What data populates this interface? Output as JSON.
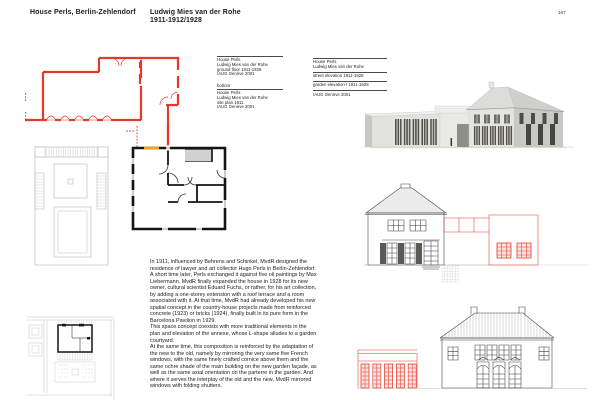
{
  "header": {
    "project": "House Perls, Berlin-Zehlendorf",
    "architect": "Ludwig Mies van der Rohe",
    "dates": "1911-1912/1928",
    "page_number": "167"
  },
  "captions": {
    "left_top": {
      "title": "House Perls",
      "architect": "Ludwig Mies van der Rohe",
      "subject": "ground floor 1911-1928",
      "credit": "IAUG Genève 2001"
    },
    "position_label": "bottom",
    "left_bottom": {
      "title": "House Perls",
      "architect": "Ludwig Mies van der Rohe",
      "subject": "site plan 1911",
      "credit": "IAUG Genève 2001"
    },
    "right": {
      "title": "House Perls",
      "architect": "Ludwig Mies van der Rohe",
      "subject_1": "street elevation 1911-1928",
      "subject_2": "garden elevation I 1911-1928",
      "credit": "IAUG Genève 2001"
    }
  },
  "body": {
    "para1": "In 1911, influenced by Behrens and Schinkel, MvdR designed the residence of lawyer and art collector Hugo Perls in Berlin-Zehlendorf. A short time later, Perls exchanged it against five oil paintings by Max Liebermann. MvdR finally expanded the house in 1928 for its new owner, cultural scientist Eduard Fuchs, or rather, for his art collection, by adding a one-storey extension with a roof terrace and a room associated with it. At that time, MvdR had already developed his new spatial concept in the country-house projects made from reinforced concrete (1923) or bricks (1924), finally built in its pure form in the Barcelona Pavilion in 1929.",
    "para2": "This space concept coexists with more traditional elements in the plan and elevation of the annexe, whose L-shape alludes to a garden courtyard.",
    "para3": "At the same time, this composition is reinforced by the adaptation of the new to the old, namely by mirroring the very same five French windows, with the same finely crafted cornice above them and the same ochre shade of the main building on the new garden façade, as well as the same axial orientation on the parterre in the garden. And where it serves the interplay of the old and the new, MvdR mirrored windows with folding shutters."
  },
  "figures": {
    "red_plan": "ground-floor plan, 1928 extension drawn in red",
    "gray_site_plan": "garden parterre plan detail",
    "black_plan": "ground-floor plan 1911, original house in black",
    "bottom_site_plan": "site plan 1911 with house and garden",
    "rendering": "digital model, view of street front with annexe",
    "street_elevation": "street elevation, extension in red",
    "garden_elevation": "garden elevation, annexe in red"
  },
  "colors": {
    "accent_red": "#e5392d",
    "highlight_yellow": "#f2a20c",
    "drawing_gray": "#bdbdbb",
    "text": "#1c1c1c",
    "paper": "#ffffff"
  }
}
